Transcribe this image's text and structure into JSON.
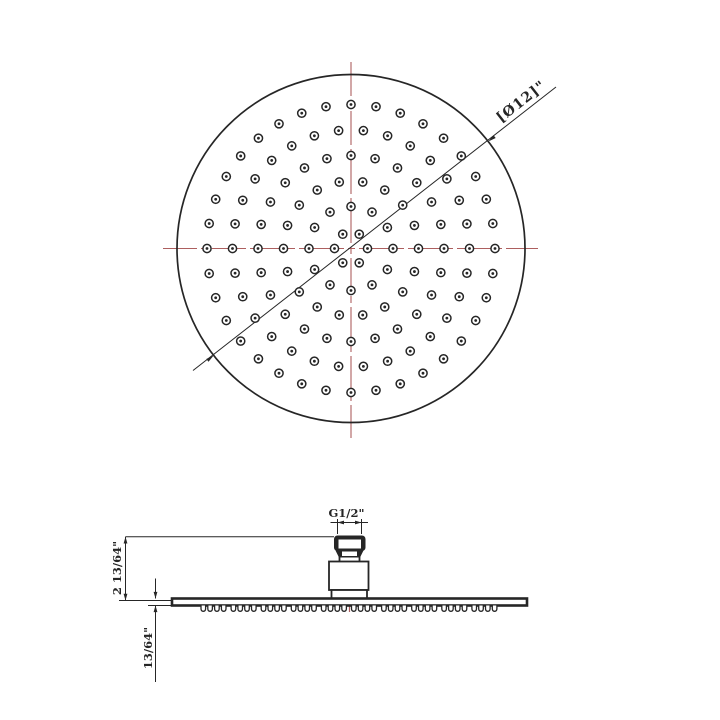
{
  "drawing_title": "showerhead-technical-drawing",
  "labels": {
    "diameter": "[Ø12]\"",
    "thread": "G1/2\"",
    "height": "2 13/64\"",
    "plate_thickness": "13/64\""
  },
  "colors": {
    "line": "#262626",
    "centerline": "#ad5f5f",
    "background": "#ffffff"
  },
  "top_view": {
    "center_x": 351,
    "center_y": 248.5,
    "radius": 174,
    "hole_outer_radius": 4.1,
    "hole_dot_radius": 1.4,
    "rings": [
      {
        "radius": 16.5,
        "count": 6
      },
      {
        "radius": 42,
        "count": 12
      },
      {
        "radius": 67.5,
        "count": 18
      },
      {
        "radius": 93,
        "count": 24
      },
      {
        "radius": 118.5,
        "count": 30
      },
      {
        "radius": 144,
        "count": 36
      }
    ]
  },
  "side_view": {
    "teeth": {
      "start_x": 201,
      "top_y": 605.5,
      "count": 40,
      "tooth_width": 4.6,
      "gap": 2.2,
      "group_size": 4,
      "group_extra_gap": 2.9
    }
  }
}
